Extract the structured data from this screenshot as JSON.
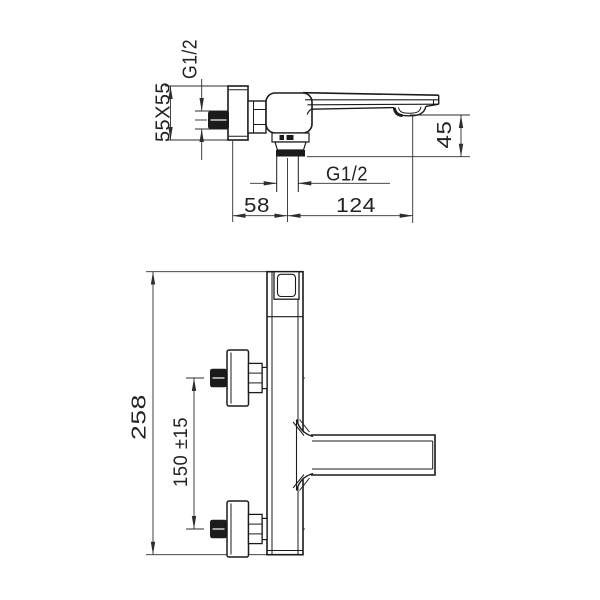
{
  "page": {
    "background": "#ffffff"
  },
  "drawing": {
    "type": "technical-dimension-drawing",
    "subject": "wall-mounted single-lever bath mixer faucet, two orthographic views",
    "line_color": "#1b1b1b",
    "dim_color": "#2e2e2e",
    "labels": {
      "side_view": {
        "inlet_thread": "G1/2",
        "flange_size": "55X55",
        "spout_drop": "45",
        "outlet_thread": "G1/2",
        "wall_to_outlet_center": "58",
        "outlet_center_to_tip": "124"
      },
      "front_view": {
        "overall_length": "258",
        "union_spacing": "150 ±15"
      }
    }
  }
}
